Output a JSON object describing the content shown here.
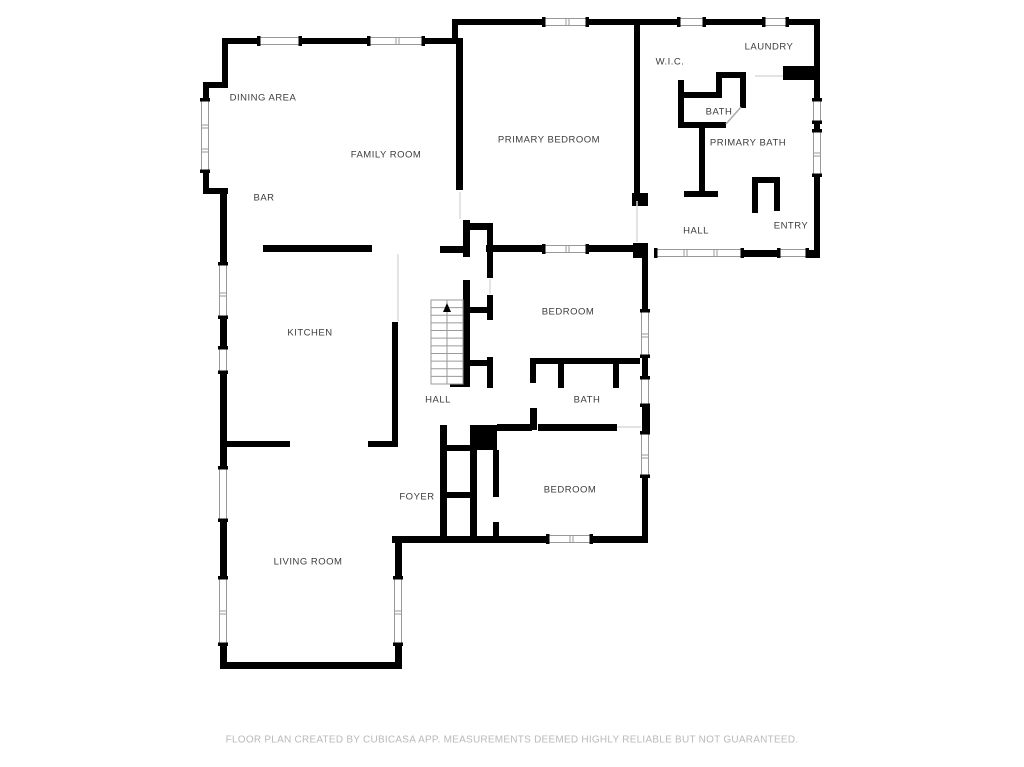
{
  "page": {
    "background": "#ffffff"
  },
  "colors": {
    "wall": "#000000",
    "label_text": "#3c3c3c",
    "footer_text": "#b9b9b9",
    "window_line": "#999999",
    "opening_line": "#dadada",
    "stair_line": "#9a9a9a"
  },
  "footer": {
    "text": "FLOOR PLAN CREATED BY CUBICASA APP. MEASUREMENTS DEEMED HIGHLY RELIABLE BUT NOT GUARANTEED."
  },
  "rooms": [
    {
      "name": "dining-area",
      "label": "DINING AREA",
      "x": 263,
      "y": 98
    },
    {
      "name": "family-room",
      "label": "FAMILY ROOM",
      "x": 386,
      "y": 155
    },
    {
      "name": "bar",
      "label": "BAR",
      "x": 264,
      "y": 198
    },
    {
      "name": "primary-bedroom",
      "label": "PRIMARY BEDROOM",
      "x": 549,
      "y": 140
    },
    {
      "name": "wic",
      "label": "W.I.C.",
      "x": 670,
      "y": 62
    },
    {
      "name": "laundry",
      "label": "LAUNDRY",
      "x": 769,
      "y": 47
    },
    {
      "name": "bath-upper",
      "label": "BATH",
      "x": 719,
      "y": 112
    },
    {
      "name": "primary-bath",
      "label": "PRIMARY BATH",
      "x": 748,
      "y": 143
    },
    {
      "name": "hall-upper",
      "label": "HALL",
      "x": 696,
      "y": 231
    },
    {
      "name": "entry",
      "label": "ENTRY",
      "x": 791,
      "y": 226
    },
    {
      "name": "kitchen",
      "label": "KITCHEN",
      "x": 310,
      "y": 333
    },
    {
      "name": "hall-middle",
      "label": "HALL",
      "x": 438,
      "y": 400
    },
    {
      "name": "bedroom-middle",
      "label": "BEDROOM",
      "x": 568,
      "y": 312
    },
    {
      "name": "bath-middle",
      "label": "BATH",
      "x": 587,
      "y": 400
    },
    {
      "name": "foyer",
      "label": "FOYER",
      "x": 417,
      "y": 497
    },
    {
      "name": "bedroom-lower",
      "label": "BEDROOM",
      "x": 570,
      "y": 490
    },
    {
      "name": "living-room",
      "label": "LIVING ROOM",
      "x": 308,
      "y": 562
    }
  ],
  "floorplan": {
    "walls": [
      [
        222,
        38,
        241,
        6
      ],
      [
        222,
        38,
        6,
        46
      ],
      [
        203,
        82,
        25,
        6
      ],
      [
        203,
        82,
        6,
        17
      ],
      [
        203,
        172,
        6,
        22
      ],
      [
        203,
        188,
        25,
        6
      ],
      [
        220,
        188,
        7,
        64
      ],
      [
        456,
        38,
        7,
        152
      ],
      [
        463,
        220,
        7,
        37
      ],
      [
        452,
        19,
        6,
        25
      ],
      [
        452,
        19,
        186,
        6
      ],
      [
        634,
        19,
        6,
        180
      ],
      [
        632,
        193,
        16,
        13
      ],
      [
        640,
        19,
        180,
        6
      ],
      [
        814,
        19,
        6,
        239
      ],
      [
        783,
        66,
        37,
        14
      ],
      [
        678,
        80,
        6,
        48
      ],
      [
        678,
        92,
        44,
        6
      ],
      [
        716,
        72,
        6,
        26
      ],
      [
        716,
        72,
        30,
        6
      ],
      [
        740,
        72,
        6,
        36
      ],
      [
        678,
        122,
        48,
        6
      ],
      [
        699,
        128,
        6,
        66
      ],
      [
        684,
        191,
        34,
        6
      ],
      [
        752,
        177,
        28,
        6
      ],
      [
        752,
        183,
        6,
        30
      ],
      [
        774,
        183,
        6,
        28
      ],
      [
        263,
        245,
        109,
        7
      ],
      [
        440,
        246,
        25,
        7
      ],
      [
        486,
        245,
        57,
        7
      ],
      [
        588,
        245,
        46,
        7
      ],
      [
        633,
        243,
        15,
        15
      ],
      [
        743,
        250,
        35,
        7
      ],
      [
        806,
        250,
        14,
        8
      ],
      [
        463,
        223,
        30,
        7
      ],
      [
        487,
        223,
        6,
        55
      ],
      [
        220,
        252,
        7,
        11
      ],
      [
        220,
        318,
        7,
        29
      ],
      [
        220,
        373,
        7,
        94
      ],
      [
        220,
        521,
        7,
        56
      ],
      [
        220,
        645,
        7,
        23
      ],
      [
        392,
        322,
        6,
        125
      ],
      [
        226,
        441,
        64,
        6
      ],
      [
        368,
        441,
        30,
        6
      ],
      [
        463,
        280,
        7,
        107
      ],
      [
        469,
        307,
        20,
        6
      ],
      [
        487,
        295,
        6,
        25
      ],
      [
        469,
        360,
        20,
        6
      ],
      [
        487,
        357,
        6,
        31
      ],
      [
        450,
        381,
        20,
        6
      ],
      [
        642,
        258,
        6,
        52
      ],
      [
        642,
        357,
        6,
        20
      ],
      [
        642,
        406,
        8,
        26
      ],
      [
        642,
        477,
        6,
        60
      ],
      [
        530,
        358,
        110,
        6
      ],
      [
        558,
        364,
        6,
        24
      ],
      [
        613,
        364,
        6,
        24
      ],
      [
        530,
        358,
        6,
        25
      ],
      [
        530,
        408,
        7,
        22
      ],
      [
        470,
        425,
        27,
        25
      ],
      [
        497,
        424,
        35,
        7
      ],
      [
        538,
        424,
        79,
        7
      ],
      [
        493,
        450,
        6,
        47
      ],
      [
        493,
        522,
        6,
        16
      ],
      [
        440,
        425,
        7,
        113
      ],
      [
        440,
        445,
        30,
        6
      ],
      [
        440,
        492,
        30,
        6
      ],
      [
        470,
        450,
        7,
        88
      ],
      [
        392,
        536,
        155,
        7
      ],
      [
        592,
        536,
        56,
        7
      ],
      [
        395,
        543,
        7,
        34
      ],
      [
        395,
        645,
        7,
        23
      ],
      [
        220,
        662,
        182,
        7
      ]
    ],
    "windows": [
      {
        "o": "h",
        "c": 41,
        "a": 258,
        "b": 301,
        "m": []
      },
      {
        "o": "h",
        "c": 41,
        "a": 368,
        "b": 424,
        "m": [
          396
        ]
      },
      {
        "o": "h",
        "c": 22,
        "a": 543,
        "b": 588,
        "m": [
          566
        ]
      },
      {
        "o": "h",
        "c": 22,
        "a": 678,
        "b": 705,
        "m": []
      },
      {
        "o": "h",
        "c": 22,
        "a": 763,
        "b": 788,
        "m": []
      },
      {
        "o": "v",
        "c": 205,
        "a": 99,
        "b": 172,
        "m": [
          125,
          149
        ]
      },
      {
        "o": "v",
        "c": 223,
        "a": 263,
        "b": 318,
        "m": [
          293
        ]
      },
      {
        "o": "v",
        "c": 223,
        "a": 347,
        "b": 373,
        "m": []
      },
      {
        "o": "v",
        "c": 223,
        "a": 467,
        "b": 521,
        "m": []
      },
      {
        "o": "v",
        "c": 223,
        "a": 577,
        "b": 645,
        "m": [
          611
        ]
      },
      {
        "o": "v",
        "c": 817,
        "a": 99,
        "b": 123,
        "m": []
      },
      {
        "o": "v",
        "c": 817,
        "a": 130,
        "b": 176,
        "m": [
          153
        ]
      },
      {
        "o": "h",
        "c": 253,
        "a": 655,
        "b": 743,
        "m": [
          684,
          714
        ]
      },
      {
        "o": "h",
        "c": 253,
        "a": 778,
        "b": 808,
        "m": []
      },
      {
        "o": "h",
        "c": 249,
        "a": 543,
        "b": 588,
        "m": [
          566
        ]
      },
      {
        "o": "v",
        "c": 645,
        "a": 310,
        "b": 357,
        "m": [
          334
        ]
      },
      {
        "o": "v",
        "c": 645,
        "a": 377,
        "b": 406,
        "m": []
      },
      {
        "o": "v",
        "c": 645,
        "a": 432,
        "b": 477,
        "m": [
          455
        ]
      },
      {
        "o": "h",
        "c": 539,
        "a": 547,
        "b": 592,
        "m": [
          570
        ]
      },
      {
        "o": "v",
        "c": 398,
        "a": 577,
        "b": 645,
        "m": [
          611
        ]
      }
    ],
    "openings": [
      [
        460,
        192,
        460,
        219
      ],
      [
        637,
        201,
        637,
        242
      ],
      [
        617,
        427,
        641,
        427
      ],
      [
        755,
        76,
        783,
        76
      ],
      [
        398,
        254,
        398,
        321
      ],
      [
        490,
        279,
        490,
        294
      ]
    ],
    "door_arcs": [
      [
        726,
        124,
        741,
        107
      ]
    ],
    "stairs": {
      "x": 431,
      "y": 300,
      "w": 32,
      "h": 84,
      "treads": 11
    }
  }
}
